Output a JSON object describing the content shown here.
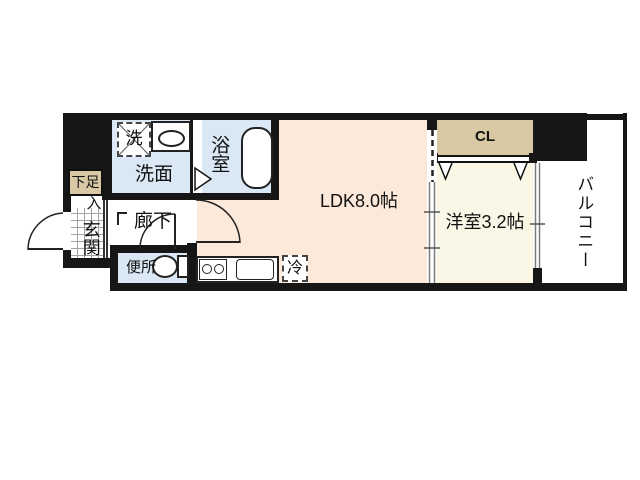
{
  "floorplan": {
    "colors": {
      "wall": "#161616",
      "ldk": "#fce9d9",
      "wet": "#dae8f5",
      "western": "#faf7e6",
      "tan": "#d8c9a4",
      "grid": "#a3a3a3",
      "rail": "#7a7a7a"
    },
    "rooms": {
      "ldk": {
        "label": "LDK8.0帖"
      },
      "western": {
        "label": "洋室3.2帖"
      },
      "closet": {
        "label": "CL"
      },
      "balcony": {
        "label": "バルコニー"
      },
      "washroom": {
        "label": "洗面"
      },
      "bathroom": {
        "label": "浴室"
      },
      "hallway": {
        "label": "廊下"
      },
      "toilet": {
        "label": "便所"
      },
      "entrance": {
        "label": "玄関"
      },
      "shoe_cupboard": {
        "label": "下足",
        "label_suffix": "入"
      }
    },
    "fixtures": {
      "washer": {
        "label": "洗"
      },
      "fridge": {
        "label": "冷"
      }
    }
  }
}
